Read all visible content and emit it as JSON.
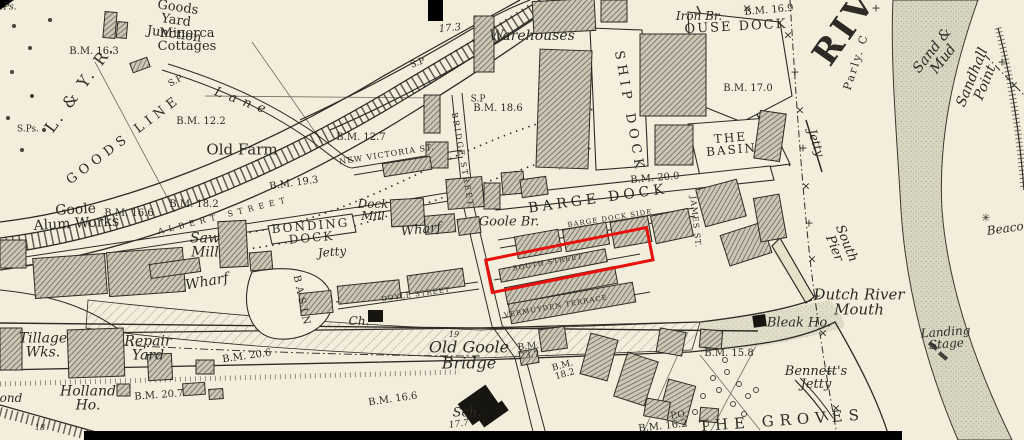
{
  "map_title": "Historical Ordnance Survey style town plan of Goole docks and Dutch River mouth",
  "colors": {
    "paper": "#f3eedb",
    "ink": "#2e2b26",
    "sand_bank": "#d8d5c1",
    "building_hatch": "#5d594f",
    "annotation_red": "#e8100c"
  },
  "annotation": {
    "name": "red-highlight-box",
    "x": 484,
    "y": 259,
    "width": 161,
    "height": 30,
    "rotation_deg": -11.5,
    "border_px": 3,
    "color": "#e8100c"
  },
  "labels": [
    {
      "name": "label-ps",
      "text": "Ps.",
      "x": 10,
      "y": 8,
      "fs": 9,
      "cls": "it"
    },
    {
      "name": "label-minorca-cottages",
      "text": "Minorca\nCottages",
      "x": 187,
      "y": 40,
      "fs": 13,
      "cls": ""
    },
    {
      "name": "label-goods-yard-junction",
      "text": "Goods\nYard\nJunction",
      "x": 176,
      "y": 21,
      "rot": 8,
      "fs": 13,
      "cls": ""
    },
    {
      "name": "label-bm-16-3",
      "text": "B.M. 16.3",
      "x": 94,
      "y": 52,
      "fs": 10,
      "cls": ""
    },
    {
      "name": "label-l-and-y-r",
      "text": "L. & Y. R.",
      "x": 80,
      "y": 88,
      "rot": -54,
      "fs": 16,
      "ls": 3,
      "cls": ""
    },
    {
      "name": "label-sp-1",
      "text": "S.P",
      "x": 176,
      "y": 82,
      "rot": -28,
      "fs": 9,
      "cls": ""
    },
    {
      "name": "label-goods-line",
      "text": "GOODS LINE",
      "x": 124,
      "y": 140,
      "rot": -37,
      "fs": 13,
      "ls": 5,
      "cls": "caps"
    },
    {
      "name": "label-sps",
      "text": "S.Ps.",
      "x": 28,
      "y": 130,
      "fs": 9,
      "cls": ""
    },
    {
      "name": "label-bm-12-2",
      "text": "B.M. 12.2",
      "x": 201,
      "y": 122,
      "fs": 10,
      "cls": ""
    },
    {
      "name": "label-old-farm",
      "text": "Old Farm",
      "x": 242,
      "y": 150,
      "fs": 15,
      "cls": ""
    },
    {
      "name": "label-lane",
      "text": "Lane",
      "x": 243,
      "y": 102,
      "rot": 20,
      "fs": 13,
      "ls": 7,
      "cls": "it"
    },
    {
      "name": "label-bm-12-7",
      "text": "B.M. 12.7",
      "x": 361,
      "y": 138,
      "fs": 10,
      "cls": ""
    },
    {
      "name": "label-new-victoria-st",
      "text": "NEW VICTORIA ST.",
      "x": 387,
      "y": 155,
      "rot": -9,
      "fs": 8,
      "ls": 1,
      "cls": "caps"
    },
    {
      "name": "label-bm-19-3",
      "text": "B.M. 19.3",
      "x": 294,
      "y": 184,
      "rot": -8,
      "fs": 10,
      "cls": ""
    },
    {
      "name": "label-bm-18-2",
      "text": "B.M. 18.2",
      "x": 194,
      "y": 205,
      "fs": 10,
      "cls": ""
    },
    {
      "name": "label-goole-alum-works",
      "text": "Goole\nAlum Works",
      "x": 76,
      "y": 217,
      "rot": -3,
      "fs": 14,
      "cls": ""
    },
    {
      "name": "label-bm-16-6",
      "text": "B.M. 16.6",
      "x": 129,
      "y": 214,
      "fs": 10,
      "cls": ""
    },
    {
      "name": "label-albert-street",
      "text": "ALBERT STREET",
      "x": 224,
      "y": 216,
      "rot": -14,
      "fs": 8,
      "ls": 5,
      "cls": "caps"
    },
    {
      "name": "label-saw-mill",
      "text": "Saw\nMill",
      "x": 205,
      "y": 246,
      "fs": 14,
      "cls": "it"
    },
    {
      "name": "label-bonding-dock",
      "text": "BONDING\nDOCK",
      "x": 311,
      "y": 232,
      "rot": -5,
      "fs": 12,
      "ls": 2,
      "cls": "caps"
    },
    {
      "name": "label-dock-mill",
      "text": "Dock\nMill",
      "x": 373,
      "y": 210,
      "fs": 12,
      "cls": "it"
    },
    {
      "name": "label-jetty-bonding",
      "text": "Jetty",
      "x": 332,
      "y": 252,
      "rot": -5,
      "fs": 12,
      "cls": "it"
    },
    {
      "name": "label-wharf-west",
      "text": "Wharf",
      "x": 207,
      "y": 282,
      "rot": -10,
      "fs": 14,
      "cls": "it"
    },
    {
      "name": "label-wharf-east",
      "text": "Wharf",
      "x": 421,
      "y": 230,
      "rot": -6,
      "fs": 13,
      "cls": "it"
    },
    {
      "name": "label-basin",
      "text": "BASIN",
      "x": 301,
      "y": 302,
      "rot": 78,
      "fs": 10,
      "ls": 4,
      "cls": "caps"
    },
    {
      "name": "label-17-3",
      "text": "17.3",
      "x": 450,
      "y": 29,
      "rot": -5,
      "fs": 10,
      "cls": "it"
    },
    {
      "name": "label-warehouses",
      "text": "Warehouses",
      "x": 532,
      "y": 36,
      "fs": 14,
      "cls": "it"
    },
    {
      "name": "label-sp-2",
      "text": "S.P",
      "x": 418,
      "y": 64,
      "rot": -20,
      "fs": 9,
      "cls": ""
    },
    {
      "name": "label-sp-3",
      "text": "S.P",
      "x": 478,
      "y": 100,
      "fs": 9,
      "cls": ""
    },
    {
      "name": "label-bm-18-6",
      "text": "B.M. 18.6",
      "x": 498,
      "y": 109,
      "fs": 10,
      "cls": ""
    },
    {
      "name": "label-bridge-street",
      "text": "BRIDGE STREET",
      "x": 462,
      "y": 160,
      "rot": 80,
      "fs": 8,
      "ls": 2,
      "cls": "caps"
    },
    {
      "name": "label-ship-dock",
      "text": "SHIP DOCK",
      "x": 629,
      "y": 112,
      "rot": 80,
      "fs": 13,
      "ls": 5,
      "cls": "caps"
    },
    {
      "name": "label-iron-br",
      "text": "Iron Br.",
      "x": 699,
      "y": 16,
      "fs": 12,
      "cls": "it"
    },
    {
      "name": "label-ouse-dock",
      "text": "OUSE DOCK",
      "x": 736,
      "y": 27,
      "rot": -3,
      "fs": 13,
      "ls": 2,
      "cls": "caps"
    },
    {
      "name": "label-bm-16-9",
      "text": "B.M. 16.9",
      "x": 769,
      "y": 11,
      "rot": -5,
      "fs": 10,
      "cls": ""
    },
    {
      "name": "label-bm-17-0",
      "text": "B.M. 17.0",
      "x": 748,
      "y": 89,
      "fs": 10,
      "cls": ""
    },
    {
      "name": "label-the-basin",
      "text": "THE\nBASIN",
      "x": 731,
      "y": 144,
      "rot": -5,
      "fs": 12,
      "ls": 2,
      "cls": "caps"
    },
    {
      "name": "label-bm-20-0",
      "text": "B.M. 20.0",
      "x": 655,
      "y": 179,
      "rot": -5,
      "fs": 10,
      "cls": ""
    },
    {
      "name": "label-barge-dock",
      "text": "BARGE DOCK",
      "x": 598,
      "y": 199,
      "rot": -8,
      "fs": 14,
      "ls": 4,
      "cls": "caps"
    },
    {
      "name": "label-goole-br",
      "text": "Goole Br.",
      "x": 509,
      "y": 222,
      "fs": 13,
      "cls": "it"
    },
    {
      "name": "label-barge-dock-side",
      "text": "BARGE DOCK SIDE",
      "x": 610,
      "y": 219,
      "rot": -9,
      "fs": 7,
      "ls": 1,
      "cls": "caps"
    },
    {
      "name": "label-south-street",
      "text": "SOUTH STREET",
      "x": 548,
      "y": 263,
      "rot": -10,
      "fs": 7,
      "ls": 1,
      "cls": "caps"
    },
    {
      "name": "label-james-st",
      "text": "JAMES ST.",
      "x": 695,
      "y": 222,
      "rot": 84,
      "fs": 8,
      "ls": 1,
      "cls": "caps"
    },
    {
      "name": "label-south-pier",
      "text": "South\nPier",
      "x": 840,
      "y": 246,
      "rot": 68,
      "fs": 13,
      "cls": "it"
    },
    {
      "name": "label-jetty-right",
      "text": "Jetty",
      "x": 816,
      "y": 143,
      "rot": 72,
      "fs": 12,
      "cls": "it"
    },
    {
      "name": "label-beacon",
      "text": "Beacon",
      "x": 1009,
      "y": 228,
      "rot": -8,
      "fs": 12,
      "cls": "it"
    },
    {
      "name": "label-sand-and-mud",
      "text": "Sand & Mud",
      "x": 938,
      "y": 55,
      "rot": -52,
      "fs": 14,
      "cls": "it"
    },
    {
      "name": "label-sandhall-point",
      "text": "Sandhall Point",
      "x": 979,
      "y": 80,
      "rot": -68,
      "fs": 14,
      "cls": "it"
    },
    {
      "name": "label-parly",
      "text": "Parly. C",
      "x": 856,
      "y": 62,
      "rot": -72,
      "fs": 11,
      "ls": 2,
      "cls": ""
    },
    {
      "name": "label-river-ouse",
      "text": "RIV",
      "x": 845,
      "y": 28,
      "rot": -55,
      "fs": 34,
      "ls": 4,
      "cls": "big"
    },
    {
      "name": "label-the-groves",
      "text": "THE GROVES",
      "x": 782,
      "y": 421,
      "rot": -4,
      "fs": 15,
      "ls": 6,
      "cls": "caps"
    },
    {
      "name": "label-bennetts-jetty",
      "text": "Bennett's\nJetty",
      "x": 816,
      "y": 378,
      "fs": 13,
      "cls": "it"
    },
    {
      "name": "label-bm-15-8",
      "text": "B.M. 15.8",
      "x": 729,
      "y": 354,
      "fs": 10,
      "cls": ""
    },
    {
      "name": "label-bleak-ho",
      "text": "Bleak Ho.",
      "x": 799,
      "y": 323,
      "fs": 13,
      "cls": "it"
    },
    {
      "name": "label-dutch-river-mouth",
      "text": "Dutch River\nMouth",
      "x": 859,
      "y": 303,
      "fs": 15,
      "cls": "it"
    },
    {
      "name": "label-landing-stage",
      "text": "Landing Stage",
      "x": 946,
      "y": 338,
      "rot": -4,
      "fs": 12,
      "cls": "it"
    },
    {
      "name": "label-tillage-wks",
      "text": "Tillage\nWks.",
      "x": 43,
      "y": 346,
      "fs": 14,
      "cls": "it"
    },
    {
      "name": "label-repair-yard",
      "text": "Repair\nYard",
      "x": 148,
      "y": 349,
      "fs": 14,
      "cls": "it"
    },
    {
      "name": "label-bm-20-6",
      "text": "B.M. 20.6",
      "x": 247,
      "y": 357,
      "rot": -8,
      "fs": 10,
      "cls": ""
    },
    {
      "name": "label-bm-20-7",
      "text": "B.M. 20.7",
      "x": 159,
      "y": 396,
      "rot": -4,
      "fs": 10,
      "cls": ""
    },
    {
      "name": "label-holland-ho",
      "text": "Holland\nHo.",
      "x": 88,
      "y": 399,
      "fs": 14,
      "cls": "it"
    },
    {
      "name": "label-pond-partial",
      "text": "ond",
      "x": 11,
      "y": 398,
      "fs": 12,
      "cls": "it"
    },
    {
      "name": "label-18",
      "text": "18",
      "x": 40,
      "y": 428,
      "fs": 8,
      "cls": "it"
    },
    {
      "name": "label-doyle-street",
      "text": "DOYLE STREET",
      "x": 416,
      "y": 295,
      "rot": -8,
      "fs": 7,
      "ls": 1,
      "cls": "caps"
    },
    {
      "name": "label-church",
      "text": "Ch.",
      "x": 359,
      "y": 321,
      "fs": 12,
      "cls": "it"
    },
    {
      "name": "label-vermuyden-terrace",
      "text": "VERMUYDEN TERRACE",
      "x": 556,
      "y": 307,
      "rot": -10,
      "fs": 7,
      "ls": 1,
      "cls": "caps"
    },
    {
      "name": "label-old-goole-bridge",
      "text": "Old Goole\nBridge",
      "x": 469,
      "y": 356,
      "fs": 16,
      "cls": "it"
    },
    {
      "name": "label-bm-23-7",
      "text": "B.M.\n23.7",
      "x": 529,
      "y": 352,
      "rot": -6,
      "fs": 9,
      "cls": ""
    },
    {
      "name": "label-bm-18-2-south",
      "text": "B.M.\n18.2",
      "x": 564,
      "y": 371,
      "rot": -15,
      "fs": 9,
      "cls": ""
    },
    {
      "name": "label-19",
      "text": "19",
      "x": 454,
      "y": 335,
      "fs": 8,
      "cls": "it"
    },
    {
      "name": "label-bm-16-6-south",
      "text": "B.M. 16.6",
      "x": 393,
      "y": 400,
      "rot": -8,
      "fs": 10,
      "cls": ""
    },
    {
      "name": "label-school",
      "text": "Sch.",
      "x": 467,
      "y": 413,
      "fs": 13,
      "cls": "it"
    },
    {
      "name": "label-17-7",
      "text": "17.7",
      "x": 459,
      "y": 425,
      "rot": -8,
      "fs": 9,
      "cls": "it"
    },
    {
      "name": "label-po",
      "text": "P.O.",
      "x": 679,
      "y": 416,
      "rot": -8,
      "fs": 9,
      "cls": ""
    },
    {
      "name": "label-bm-16-2",
      "text": "B.M. 16.2",
      "x": 663,
      "y": 427,
      "rot": -6,
      "fs": 10,
      "cls": ""
    }
  ],
  "boundary_marks": [
    {
      "x": 747,
      "y": 8,
      "g": "×"
    },
    {
      "x": 788,
      "y": 35,
      "g": "×"
    },
    {
      "x": 795,
      "y": 72,
      "g": "+"
    },
    {
      "x": 800,
      "y": 110,
      "g": "×"
    },
    {
      "x": 803,
      "y": 148,
      "g": "+"
    },
    {
      "x": 806,
      "y": 186,
      "g": "×"
    },
    {
      "x": 809,
      "y": 223,
      "g": "+"
    },
    {
      "x": 812,
      "y": 259,
      "g": "×"
    },
    {
      "x": 817,
      "y": 296,
      "g": "+"
    },
    {
      "x": 823,
      "y": 333,
      "g": "×"
    },
    {
      "x": 829,
      "y": 371,
      "g": "+"
    },
    {
      "x": 836,
      "y": 408,
      "g": "×"
    },
    {
      "x": 842,
      "y": 435,
      "g": "+"
    },
    {
      "x": 876,
      "y": 8,
      "g": "+"
    },
    {
      "x": 1002,
      "y": 62,
      "g": "+"
    },
    {
      "x": 1014,
      "y": 85,
      "g": "×"
    },
    {
      "x": 986,
      "y": 218,
      "g": "✳"
    }
  ]
}
